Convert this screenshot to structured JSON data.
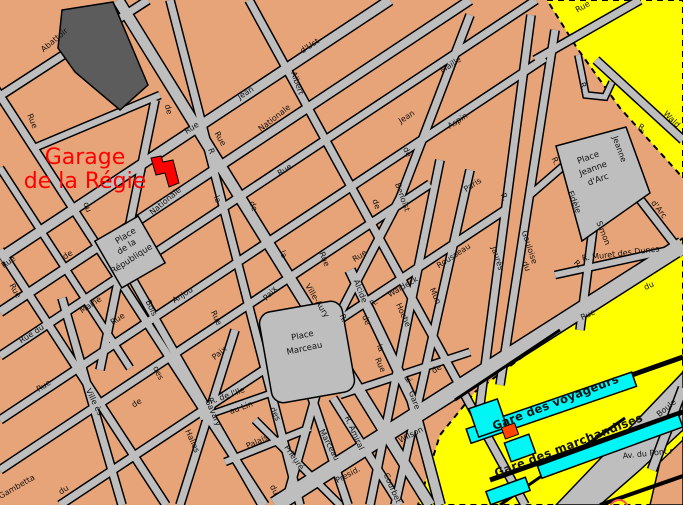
{
  "annotation": {
    "line1": "Garage",
    "line2": "de la Régie"
  },
  "colors": {
    "annotation_red": "#FF0000",
    "background_tan": "#E8A479",
    "street_gray": "#BEBEBE",
    "railway_yellow": "#FFFF00",
    "station_cyan": "#00F5F5",
    "garage_red": "#FF0000",
    "dark_building_gray": "#5C5C5C"
  },
  "labels": [
    {
      "t": "Abattoir",
      "x": 56,
      "y": 42,
      "r": -40,
      "cls": "st"
    },
    {
      "t": "Rue",
      "x": 30,
      "y": 122,
      "r": 68,
      "cls": "st"
    },
    {
      "t": "de",
      "x": 166,
      "y": 110,
      "r": 75,
      "cls": "st"
    },
    {
      "t": "Rue",
      "x": 218,
      "y": 140,
      "r": 60,
      "cls": "st"
    },
    {
      "t": "Rue",
      "x": 193,
      "y": 130,
      "r": -33,
      "cls": "st"
    },
    {
      "t": "Jean",
      "x": 247,
      "y": 95,
      "r": -33,
      "s": 9,
      "cls": "st"
    },
    {
      "t": "d'Ust",
      "x": 311,
      "y": 48,
      "r": -33,
      "cls": "st"
    },
    {
      "t": "Albert",
      "x": 295,
      "y": 84,
      "r": 70,
      "cls": "st"
    },
    {
      "t": "Nationale",
      "x": 276,
      "y": 120,
      "r": -38,
      "cls": "st"
    },
    {
      "t": "Nationale",
      "x": 167,
      "y": 203,
      "r": -40,
      "cls": "st"
    },
    {
      "t": "Maille",
      "x": 452,
      "y": 67,
      "r": -33,
      "cls": "st"
    },
    {
      "t": "Aspin",
      "x": 459,
      "y": 123,
      "r": -33,
      "cls": "st"
    },
    {
      "t": "Jean",
      "x": 408,
      "y": 119,
      "r": -33,
      "cls": "st"
    },
    {
      "t": "Rue",
      "x": 584,
      "y": 9,
      "r": -30,
      "cls": "st"
    },
    {
      "t": "R.",
      "x": 581,
      "y": 87,
      "r": 70,
      "cls": "st"
    },
    {
      "t": "Wald",
      "x": 670,
      "y": 121,
      "r": 45,
      "cls": "st"
    },
    {
      "t": "R.",
      "x": 641,
      "y": 130,
      "r": 30,
      "cls": "st"
    },
    {
      "t": "Jeanne",
      "x": 617,
      "y": 150,
      "r": 70,
      "cls": "st"
    },
    {
      "t": "R.",
      "x": 553,
      "y": 162,
      "r": 65,
      "cls": "st"
    },
    {
      "t": "Fidèle",
      "x": 572,
      "y": 203,
      "r": 68,
      "cls": "st"
    },
    {
      "t": "Simon",
      "x": 601,
      "y": 234,
      "r": 68,
      "cls": "st"
    },
    {
      "t": "d'Arc",
      "x": 657,
      "y": 211,
      "r": 52,
      "cls": "st"
    },
    {
      "t": "R. Muret des Dunes",
      "x": 621,
      "y": 256,
      "r": -7,
      "cls": "st"
    },
    {
      "t": "du",
      "x": 85,
      "y": 208,
      "r": 70,
      "cls": "st"
    },
    {
      "t": "de",
      "x": 69,
      "y": 257,
      "r": -33,
      "cls": "st"
    },
    {
      "t": "Rue",
      "x": 10,
      "y": 264,
      "r": -35,
      "cls": "st"
    },
    {
      "t": "Rue",
      "x": 13,
      "y": 292,
      "r": 60,
      "cls": "st"
    },
    {
      "t": "la",
      "x": 215,
      "y": 200,
      "r": 70,
      "cls": "st"
    },
    {
      "t": "R",
      "x": 209,
      "y": 152,
      "r": 70,
      "cls": "st"
    },
    {
      "t": "Rue",
      "x": 286,
      "y": 172,
      "r": -33,
      "cls": "st"
    },
    {
      "t": "de",
      "x": 374,
      "y": 205,
      "r": 70,
      "cls": "st"
    },
    {
      "t": "de",
      "x": 405,
      "y": 153,
      "r": 65,
      "cls": "st"
    },
    {
      "t": "Benoist",
      "x": 400,
      "y": 198,
      "r": 70,
      "cls": "st"
    },
    {
      "t": "de",
      "x": 251,
      "y": 207,
      "r": 70,
      "cls": "st"
    },
    {
      "t": "la",
      "x": 281,
      "y": 255,
      "r": 70,
      "cls": "st"
    },
    {
      "t": "Rue",
      "x": 322,
      "y": 260,
      "r": 68,
      "cls": "st"
    },
    {
      "t": "Rue",
      "x": 361,
      "y": 258,
      "r": -33,
      "cls": "st"
    },
    {
      "t": "Rousseau",
      "x": 455,
      "y": 258,
      "r": -33,
      "cls": "st"
    },
    {
      "t": "Paris",
      "x": 474,
      "y": 187,
      "r": -33,
      "cls": "st"
    },
    {
      "t": "R.",
      "x": 502,
      "y": 198,
      "r": 65,
      "cls": "st"
    },
    {
      "t": "Gauloise",
      "x": 527,
      "y": 248,
      "r": 72,
      "cls": "st"
    },
    {
      "t": "Jaurès",
      "x": 495,
      "y": 259,
      "r": 72,
      "cls": "st"
    },
    {
      "t": "du",
      "x": 524,
      "y": 267,
      "r": 70,
      "cls": "st"
    },
    {
      "t": "R.",
      "x": 576,
      "y": 266,
      "r": 45,
      "cls": "st"
    },
    {
      "t": "Paix",
      "x": 272,
      "y": 295,
      "r": -48,
      "cls": "st"
    },
    {
      "t": "Ville-Aury",
      "x": 315,
      "y": 302,
      "r": 58,
      "cls": "st"
    },
    {
      "t": "R.",
      "x": 341,
      "y": 319,
      "r": 68,
      "cls": "st"
    },
    {
      "t": "Alcide",
      "x": 358,
      "y": 292,
      "r": 68,
      "cls": "st"
    },
    {
      "t": "R.",
      "x": 375,
      "y": 305,
      "r": -30,
      "cls": "st"
    },
    {
      "t": "Waldeck",
      "x": 404,
      "y": 289,
      "r": -30,
      "cls": "st"
    },
    {
      "t": "Hoche",
      "x": 401,
      "y": 316,
      "r": 66,
      "cls": "st"
    },
    {
      "t": "Mun",
      "x": 433,
      "y": 297,
      "r": 66,
      "cls": "st"
    },
    {
      "t": "de",
      "x": 438,
      "y": 371,
      "r": -33,
      "cls": "st"
    },
    {
      "t": "R.",
      "x": 410,
      "y": 381,
      "r": -33,
      "cls": "st"
    },
    {
      "t": "Rue",
      "x": 378,
      "y": 366,
      "r": 66,
      "cls": "st"
    },
    {
      "t": "la",
      "x": 378,
      "y": 349,
      "r": 66,
      "cls": "st"
    },
    {
      "t": "de",
      "x": 364,
      "y": 321,
      "r": 66,
      "cls": "st"
    },
    {
      "t": "Maine",
      "x": 92,
      "y": 307,
      "r": -33,
      "cls": "st"
    },
    {
      "t": "Rue du",
      "x": 33,
      "y": 336,
      "r": -33,
      "cls": "st"
    },
    {
      "t": "Anjou",
      "x": 184,
      "y": 297,
      "r": -33,
      "cls": "st"
    },
    {
      "t": "Bois",
      "x": 149,
      "y": 309,
      "r": 64,
      "cls": "st"
    },
    {
      "t": "Rue",
      "x": 119,
      "y": 321,
      "r": -33,
      "cls": "st"
    },
    {
      "t": "Rue",
      "x": 214,
      "y": 319,
      "r": 64,
      "cls": "st"
    },
    {
      "t": "Paix",
      "x": 221,
      "y": 355,
      "r": -40,
      "cls": "st"
    },
    {
      "t": "des",
      "x": 156,
      "y": 374,
      "r": 64,
      "cls": "st"
    },
    {
      "t": "Rue",
      "x": 45,
      "y": 388,
      "r": -33,
      "cls": "st"
    },
    {
      "t": "Ville ès",
      "x": 92,
      "y": 403,
      "r": 64,
      "cls": "st"
    },
    {
      "t": "de",
      "x": 138,
      "y": 405,
      "r": -33,
      "cls": "st"
    },
    {
      "t": "Halles",
      "x": 190,
      "y": 442,
      "r": 66,
      "cls": "st"
    },
    {
      "t": "Savary",
      "x": 211,
      "y": 414,
      "r": 66,
      "cls": "st"
    },
    {
      "t": "R. de l'Ile",
      "x": 228,
      "y": 398,
      "r": -20,
      "cls": "st"
    },
    {
      "t": "au Lin",
      "x": 242,
      "y": 410,
      "r": -20,
      "cls": "st"
    },
    {
      "t": "des",
      "x": 273,
      "y": 415,
      "r": 64,
      "cls": "st"
    },
    {
      "t": "Palais",
      "x": 258,
      "y": 444,
      "r": -25,
      "cls": "st"
    },
    {
      "t": "Prieuré",
      "x": 292,
      "y": 459,
      "r": 55,
      "cls": "st"
    },
    {
      "t": "du",
      "x": 272,
      "y": 491,
      "r": 64,
      "cls": "st"
    },
    {
      "t": "Marceau",
      "x": 327,
      "y": 446,
      "r": 62,
      "cls": "st"
    },
    {
      "t": "Gambetta",
      "x": 18,
      "y": 489,
      "r": -30,
      "cls": "st"
    },
    {
      "t": "du",
      "x": 65,
      "y": 492,
      "r": -33,
      "cls": "st"
    },
    {
      "t": "R. Amiral",
      "x": 352,
      "y": 434,
      "r": 66,
      "cls": "st"
    },
    {
      "t": "Courbet",
      "x": 390,
      "y": 489,
      "r": 66,
      "cls": "st"
    },
    {
      "t": "Presid.",
      "x": 349,
      "y": 477,
      "r": -28,
      "s": 10,
      "cls": "st"
    },
    {
      "t": "Wilson",
      "x": 412,
      "y": 437,
      "r": -28,
      "s": 11,
      "cls": "st"
    },
    {
      "t": "Gare",
      "x": 412,
      "y": 401,
      "r": 70,
      "s": 9,
      "cls": "st"
    },
    {
      "t": "Rue",
      "x": 589,
      "y": 317,
      "r": -25,
      "s": 10,
      "cls": "st"
    },
    {
      "t": "du",
      "x": 650,
      "y": 288,
      "r": -25,
      "s": 10,
      "cls": "st"
    },
    {
      "t": "Av. du Pont r",
      "x": 648,
      "y": 456,
      "r": -6,
      "s": 9,
      "cls": "st"
    },
    {
      "t": "Boule",
      "x": 668,
      "y": 410,
      "r": -40,
      "s": 9,
      "cls": "st"
    },
    {
      "t": "Place",
      "x": 127,
      "y": 238,
      "r": -33,
      "cls": "place"
    },
    {
      "t": "de la",
      "x": 128,
      "y": 249,
      "r": -33,
      "cls": "place"
    },
    {
      "t": "République",
      "x": 133,
      "y": 261,
      "r": -33,
      "cls": "place"
    },
    {
      "t": "Place",
      "x": 303,
      "y": 338,
      "r": -12,
      "s": 9,
      "cls": "place"
    },
    {
      "t": "Marceau",
      "x": 305,
      "y": 351,
      "r": -12,
      "s": 9,
      "cls": "place"
    },
    {
      "t": "Place",
      "x": 589,
      "y": 160,
      "r": -20,
      "cls": "place"
    },
    {
      "t": "Jeanne",
      "x": 594,
      "y": 171,
      "r": -20,
      "cls": "place"
    },
    {
      "t": "d'Arc",
      "x": 599,
      "y": 182,
      "r": -20,
      "cls": "place"
    },
    {
      "t": "Gare des voyageurs",
      "x": 557,
      "y": 406,
      "r": -21,
      "cls": "station"
    },
    {
      "t": "Gare des marchandises",
      "x": 570,
      "y": 449,
      "r": -21,
      "cls": "station"
    }
  ]
}
